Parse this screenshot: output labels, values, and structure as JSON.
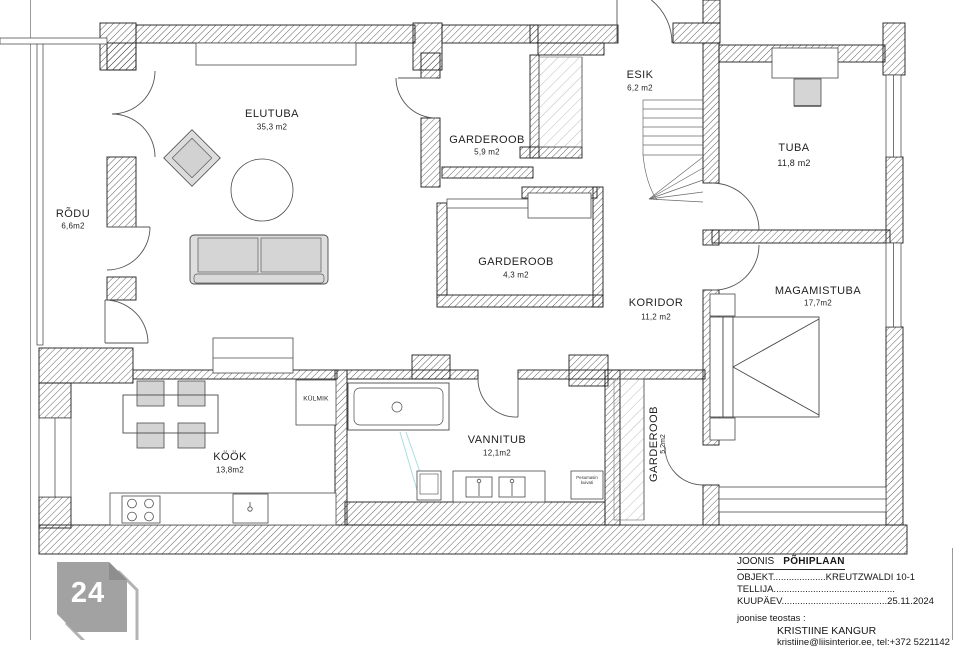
{
  "plan": {
    "rooms": {
      "elutuba": {
        "name": "ELUTUBA",
        "area": "35,3 m2"
      },
      "rodu": {
        "name": "RÕDU",
        "area": "6,6m2"
      },
      "garderoob_59": {
        "name": "GARDEROOB",
        "area": "5,9 m2"
      },
      "esik": {
        "name": "ESIK",
        "area": "6,2 m2"
      },
      "tuba": {
        "name": "TUBA",
        "area": "11,8 m2"
      },
      "garderoob_43": {
        "name": "GARDEROOB",
        "area": "4,3 m2"
      },
      "koridor": {
        "name": "KORIDOR",
        "area": "11,2 m2"
      },
      "magamistuba": {
        "name": "MAGAMISTUBA",
        "area": "17,7m2"
      },
      "kook": {
        "name": "KÖÖK",
        "area": "13,8m2"
      },
      "vannituba": {
        "name": "VANNITUB",
        "area": "12,1m2"
      },
      "garderoob_52": {
        "name": "GARDEROOB",
        "area": "5,2m2"
      }
    },
    "labels": {
      "fridge": "KÜLMIK",
      "washer_line1": "Pesumasin",
      "washer_line2": "kuivati"
    }
  },
  "title_block": {
    "joonis_label": "JOONIS",
    "joonis_value": "PÕHIPLAAN",
    "objekt": "OBJEKT....................KREUTZWALDI 10-1",
    "tellija": "TELLIJA..............................................",
    "kuupaev": "KUUPÄEV........................................25.11.2024",
    "teostas_label": "joonise teostas :",
    "author": "KRISTIINE KANGUR",
    "contact": "kristiine@liisinterior.ee, tel:+372 5221142"
  },
  "logo": {
    "label": "24"
  },
  "colors": {
    "wall_line": "#1c1c1c",
    "furniture_gray": "#d7d7d7",
    "logo_gray": "#a2a2a2",
    "pipe_teal": "#a9dde0"
  }
}
